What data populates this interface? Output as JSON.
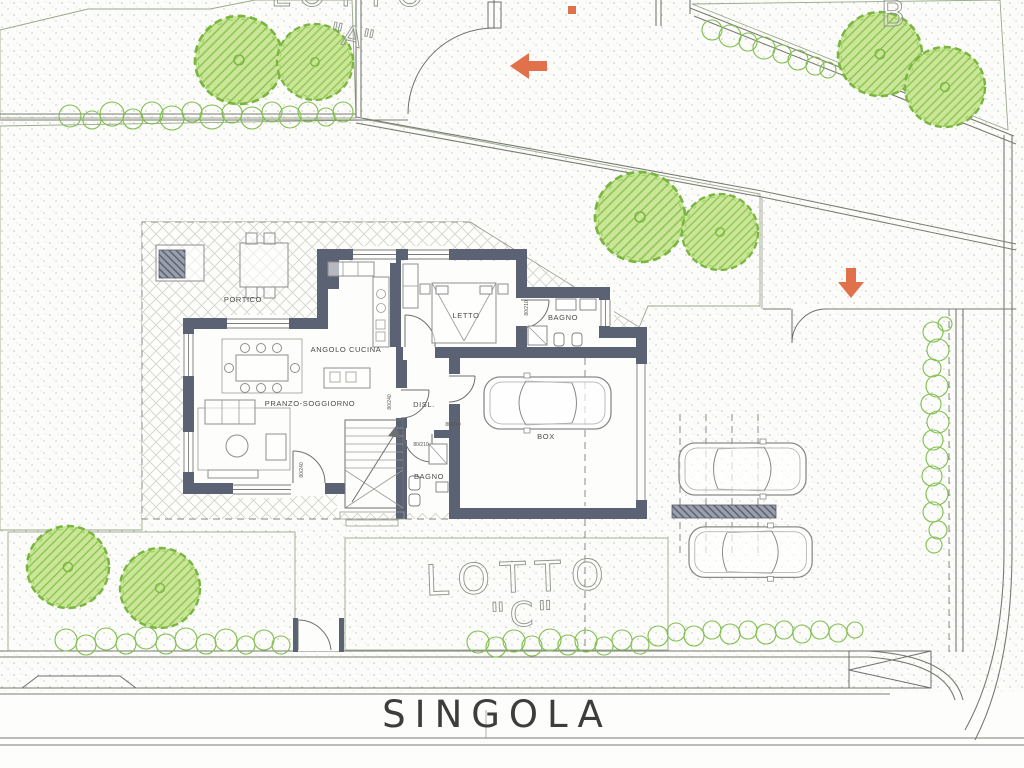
{
  "site_plan": {
    "lots": {
      "lot_a_word": "LOTTO",
      "lot_a_letter": "\"A\"",
      "lot_b_letter": "B",
      "lot_c_word": "LOTTO",
      "lot_c_letter": "\"C\""
    },
    "street_name": "SINGOLA",
    "rooms": {
      "portico": "PORTICO",
      "angolo_cucina": "ANGOLO CUCINA",
      "pranzo_soggiorno": "PRANZO-SOGGIORNO",
      "letto": "LETTO",
      "bagno_top": "BAGNO",
      "disl": "DISL.",
      "bagno_bottom": "BAGNO",
      "box": "BOX"
    },
    "door_dimensions": [
      "80/240",
      "80/210",
      "80/210",
      "80/210",
      "80/240"
    ],
    "colors": {
      "wall": "#5b6273",
      "accent_orange": "#e0714b",
      "lawn": "#eef3da",
      "lawn_line": "#b3cf86",
      "tree_fill": "#cbe698",
      "tree_line": "#8cc653",
      "tree_edge": "#79b53f",
      "paving_line": "#d2d2ca",
      "stipple": "#c2c2b8"
    }
  }
}
